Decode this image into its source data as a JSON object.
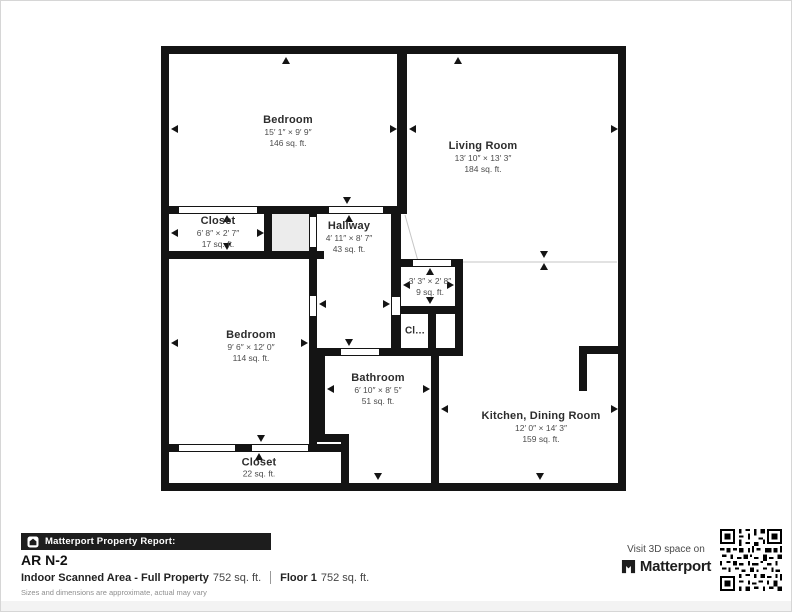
{
  "rooms": [
    {
      "name": "Bedroom",
      "dims": "15′ 1″ × 9′ 9″",
      "area": "146 sq. ft."
    },
    {
      "name": "Living Room",
      "dims": "13′ 10″ × 13′ 3″",
      "area": "184 sq. ft."
    },
    {
      "name": "Closet",
      "dims": "6′ 8″ × 2′ 7″",
      "area": "17 sq. ft."
    },
    {
      "name": "Hallway",
      "dims": "4′ 11″ × 8′ 7″",
      "area": "43 sq. ft."
    },
    {
      "name": "",
      "dims": "3′ 3″ × 2′ 8″",
      "area": "9 sq. ft."
    },
    {
      "name": "Cl…",
      "dims": "",
      "area": ""
    },
    {
      "name": "Bedroom",
      "dims": "9′ 6″ × 12′ 0″",
      "area": "114 sq. ft."
    },
    {
      "name": "Bathroom",
      "dims": "6′ 10″ × 8′ 5″",
      "area": "51 sq. ft."
    },
    {
      "name": "Kitchen, Dining Room",
      "dims": "12′ 0″ × 14′ 3″",
      "area": "159 sq. ft."
    },
    {
      "name": "Closet",
      "dims": "",
      "area": "22 sq. ft."
    }
  ],
  "footer": {
    "report_bar_title": "Matterport Property Report:",
    "property_name": "AR N-2",
    "indoor_label": "Indoor Scanned Area - Full Property",
    "indoor_value": "752 sq. ft.",
    "floor_label": "Floor 1",
    "floor_value": "752 sq. ft.",
    "disclaimer": "Sizes and dimensions are approximate, actual may vary",
    "visit_line": "Visit 3D space on",
    "brand": "Matterport"
  },
  "colors": {
    "wall": "#141414",
    "bar_background": "#1d1d1d",
    "unlabeled_room_fill": "#ececec"
  }
}
